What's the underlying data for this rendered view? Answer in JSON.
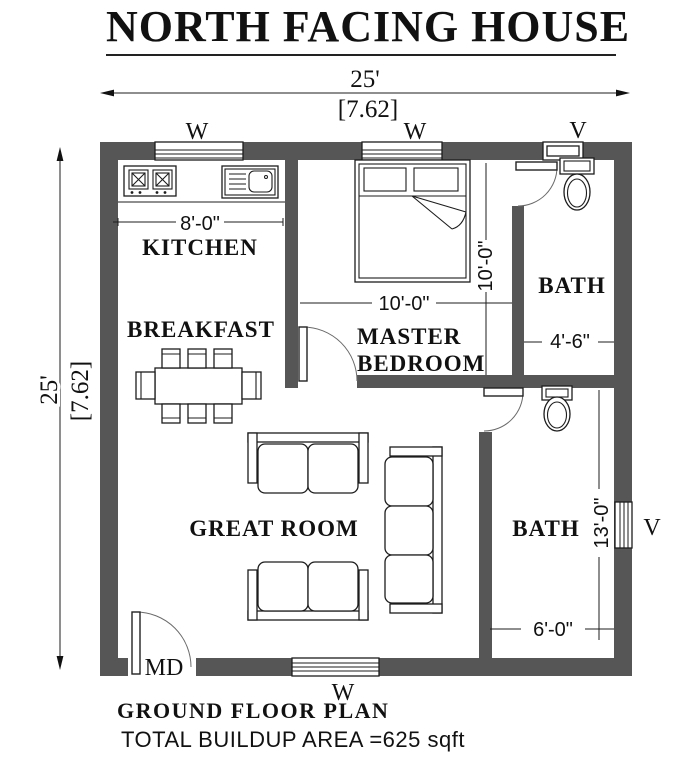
{
  "colors": {
    "wall": "#565656",
    "line": "#111111"
  },
  "title": "NORTH FACING HOUSE",
  "dimensions": {
    "top_feet": "25'",
    "top_meters": "[7.62]",
    "left_feet": "25'",
    "left_meters": "[7.62]",
    "kitchen_width": "8'-0\"",
    "master_width": "10'-0\"",
    "master_depth": "10'-0\"",
    "bath_top_width": "4'-6\"",
    "bath_bottom_depth": "13'-0\"",
    "bath_bottom_width": "6'-0\""
  },
  "rooms": {
    "kitchen": "KITCHEN",
    "breakfast": "BREAKFAST",
    "master_line1": "MASTER",
    "master_line2": "BEDROOM",
    "great_room": "GREAT ROOM",
    "bath_top": "BATH",
    "bath_bottom": "BATH"
  },
  "openings": {
    "window_kitchen": "W",
    "window_master": "W",
    "vent_top": "V",
    "vent_right": "V",
    "window_bottom": "W",
    "main_door": "MD"
  },
  "footer": {
    "plan_name": "GROUND FLOOR PLAN",
    "area": "TOTAL BUILDUP AREA =625 sqft"
  }
}
